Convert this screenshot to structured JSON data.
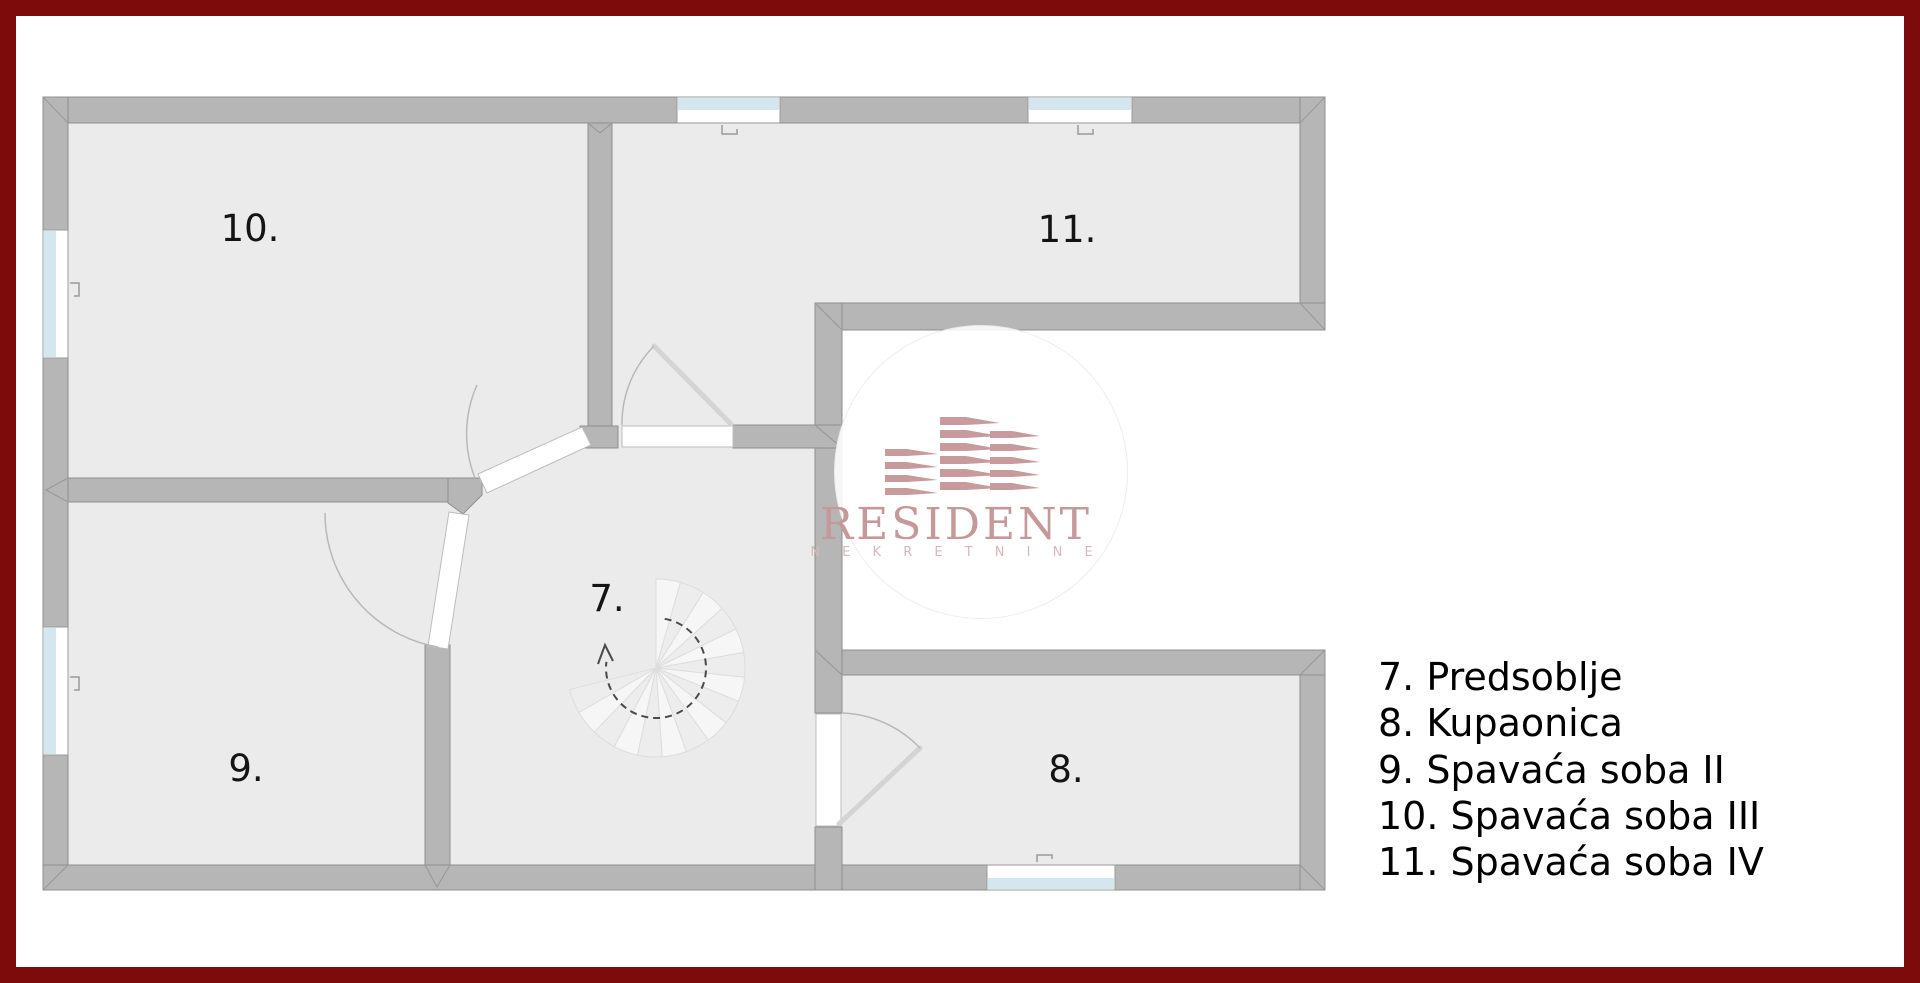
{
  "floor_plan": {
    "room_labels": {
      "hallway": "7.",
      "bathroom": "8.",
      "bedroom2": "9.",
      "bedroom3": "10.",
      "bedroom4": "11."
    },
    "features": {
      "staircase": "spiral-staircase",
      "stair_direction": "clockwise-up-arrow",
      "windows": 5,
      "doors": 4
    }
  },
  "legend": {
    "items": [
      "7. Predsoblje",
      "8. Kupaonica",
      "9. Spavaća soba II",
      "10. Spavaća soba III",
      "11. Spavaća soba IV"
    ]
  },
  "watermark": {
    "brand": "RESIDENT",
    "subtitle": "N E K R E T N I N E"
  },
  "colors": {
    "frame_red": "#7d0b0b",
    "wall_gray": "#b6b6b6",
    "wall_outline": "#8f8f8f",
    "floor_gray": "#ebebeb",
    "window_blue": "#d5e7ee",
    "door_arc_gray": "#b8b8b8",
    "stair_light": "#f6f6f6",
    "stair_dark": "#ededed",
    "logo_pink": "#c59899",
    "logo_pink_light": "#d6b8b8",
    "label_black": "#141414"
  }
}
